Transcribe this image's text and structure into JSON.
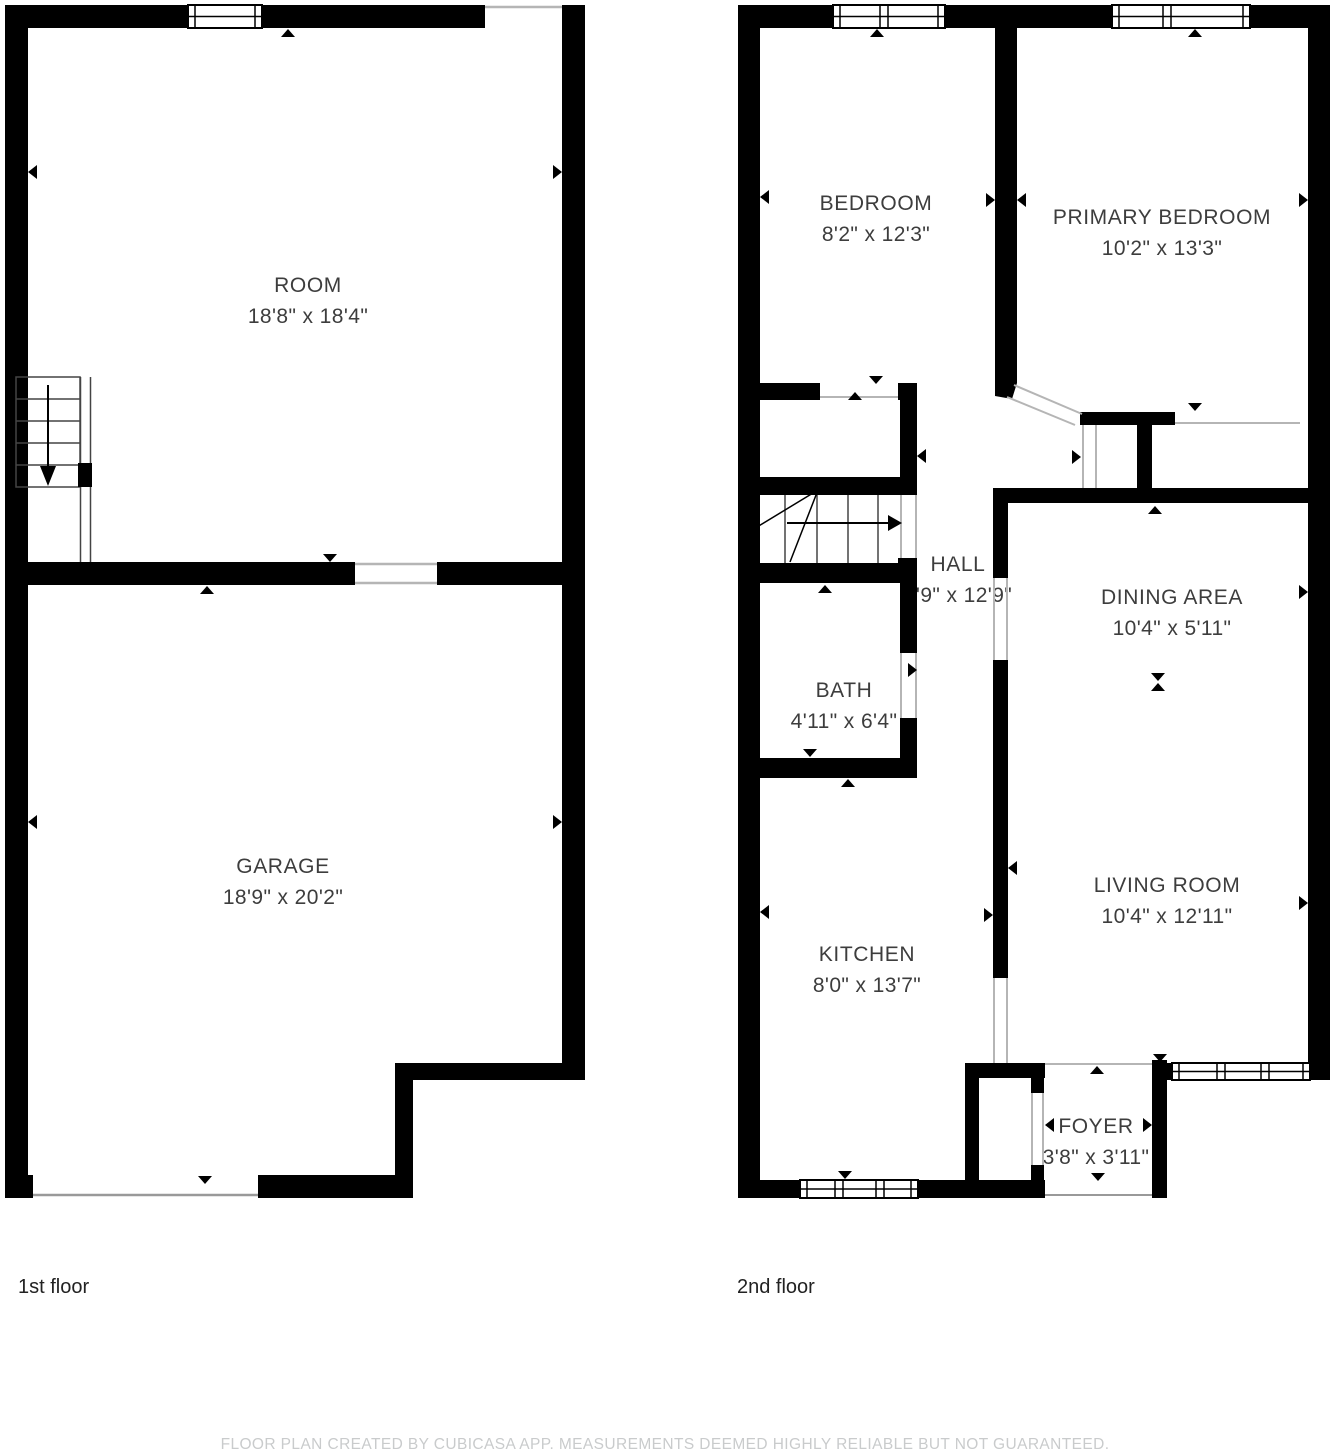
{
  "floors": [
    {
      "label": "1st floor",
      "rooms": [
        {
          "name": "ROOM",
          "dims": "18'8\" x 18'4\""
        },
        {
          "name": "GARAGE",
          "dims": "18'9\" x 20'2\""
        }
      ]
    },
    {
      "label": "2nd floor",
      "rooms": [
        {
          "name": "BEDROOM",
          "dims": "8'2\" x 12'3\""
        },
        {
          "name": "PRIMARY BEDROOM",
          "dims": "10'2\" x 13'3\""
        },
        {
          "name": "HALL",
          "dims": "3'9\" x 12'9\""
        },
        {
          "name": "DINING AREA",
          "dims": "10'4\" x 5'11\""
        },
        {
          "name": "BATH",
          "dims": "4'11\" x 6'4\""
        },
        {
          "name": "KITCHEN",
          "dims": "8'0\" x 13'7\""
        },
        {
          "name": "LIVING ROOM",
          "dims": "10'4\" x 12'11\""
        },
        {
          "name": "FOYER",
          "dims": "3'8\" x 3'11\""
        }
      ]
    }
  ],
  "footer": "FLOOR PLAN CREATED BY CUBICASA APP. MEASUREMENTS DEEMED HIGHLY RELIABLE BUT NOT GUARANTEED.",
  "colors": {
    "wall": "#000000",
    "background": "#ffffff",
    "label_text": "#3d3d3d",
    "footer_text": "#c9cbcc",
    "thin_line": "#b5b5b5"
  }
}
